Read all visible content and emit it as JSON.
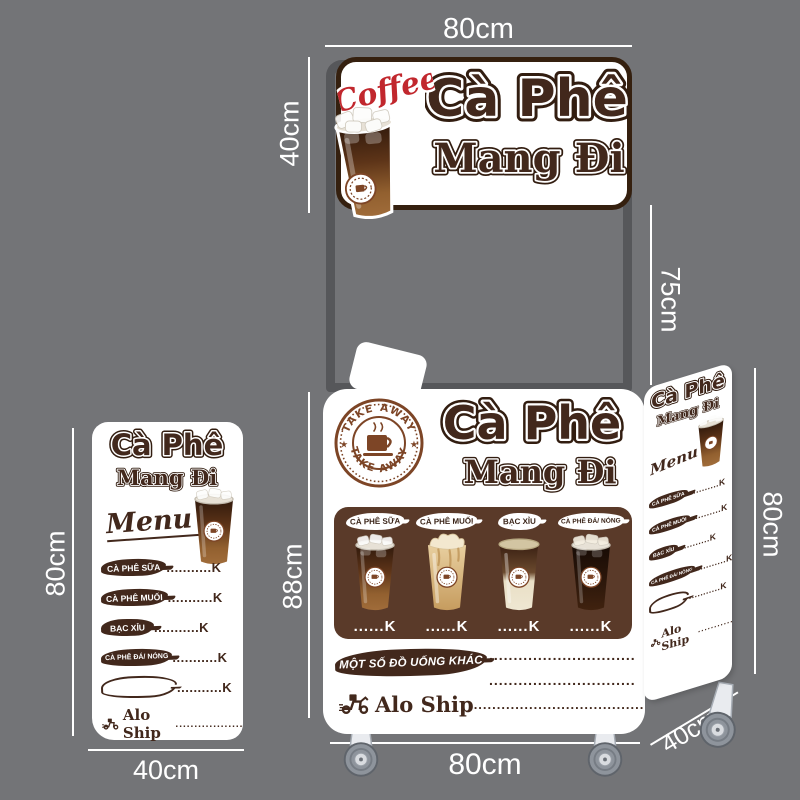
{
  "colors": {
    "background": "#737477",
    "frame_gray": "#56575a",
    "brand_brown": "#42281c",
    "dark_outline": "#321d10",
    "panel_brown": "#5a3a29",
    "stamp_brown": "#7d4526",
    "coffee_red": "#c1272d",
    "dimension_text": "#ffffff"
  },
  "dimensions": {
    "sign_width": "80cm",
    "sign_height": "40cm",
    "pole_height": "75cm",
    "cart_height": "88cm",
    "cart_width": "80cm",
    "right_panel_height": "80cm",
    "right_panel_depth": "40cm",
    "left_panel_height": "80cm",
    "left_panel_width": "40cm"
  },
  "sign": {
    "script": "Coffee",
    "title1": "Cà Phê",
    "title2": "Mang Đi"
  },
  "stamp": {
    "arc_top": "TAKE AWAY",
    "arc_bottom": "TAKE AWAY"
  },
  "cart": {
    "title1": "Cà Phê",
    "title2": "Mang Đi",
    "menu": [
      {
        "label": "CÀ PHÊ SỮA",
        "price": "......K",
        "cup": "iced-milk-coffee-cup"
      },
      {
        "label": "CÀ PHÊ MUỐI",
        "price": "......K",
        "cup": "salt-cream-coffee-cup"
      },
      {
        "label": "BẠC XỈU",
        "price": "......K",
        "cup": "bac-xiu-cup"
      },
      {
        "label": "CÀ PHÊ ĐÁ/ NÓNG",
        "price": "......K",
        "cup": "black-iced-coffee-cup"
      }
    ],
    "other_drinks": "MỘT SỐ ĐỒ UỐNG KHÁC",
    "other_line1": "..............................",
    "other_line2": "..............................",
    "ship": "Alo Ship",
    "ship_dots": "....................................."
  },
  "panel": {
    "title1": "Cà Phê",
    "title2": "Mang Đi",
    "menu_word": "Menu",
    "items": [
      {
        "label": "CÀ PHÊ SỮA",
        "price": "...........K"
      },
      {
        "label": "CÀ PHÊ MUỐI",
        "price": "...........K"
      },
      {
        "label": "BẠC XỈU",
        "price": "...........K"
      },
      {
        "label": "CÀ PHÊ ĐÁ/ NÓNG",
        "price": "...........K"
      },
      {
        "label": "",
        "price": "...........K"
      }
    ],
    "ship": "Alo Ship",
    "ship_dots": "........................"
  }
}
